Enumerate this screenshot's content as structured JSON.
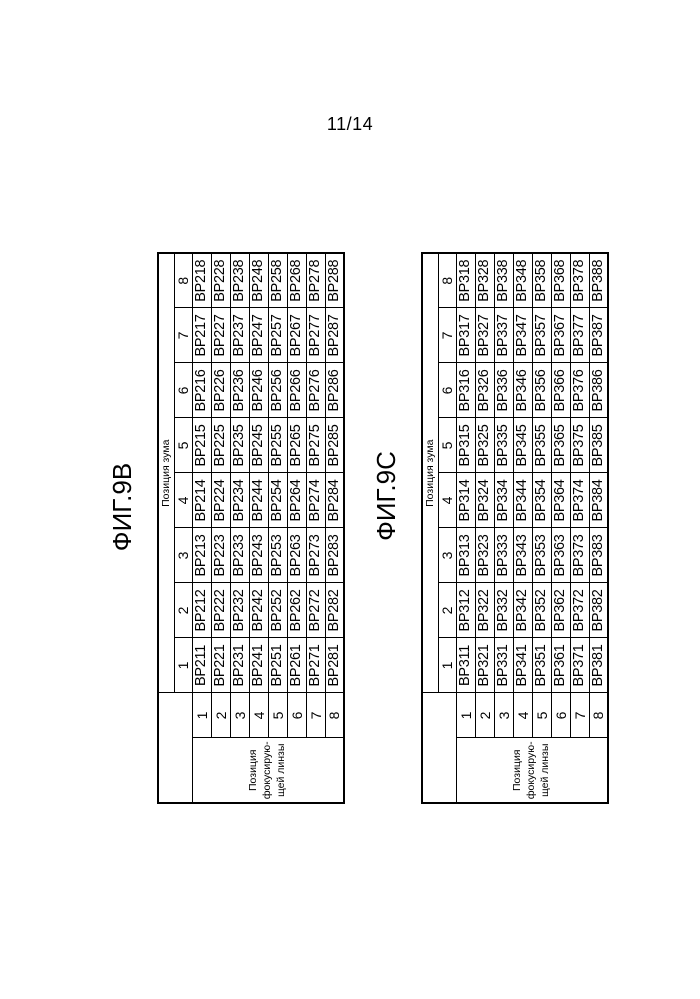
{
  "page_number": "11/14",
  "colors": {
    "ink": "#000000",
    "paper": "#ffffff"
  },
  "figures": [
    {
      "label": "ФИГ.9В",
      "zoom_header": "Позиция зума",
      "focus_header_lines": [
        "Позиция",
        "фокусирую-",
        "щей линзы"
      ],
      "zoom_positions": [
        "1",
        "2",
        "3",
        "4",
        "5",
        "6",
        "7",
        "8"
      ],
      "focus_positions": [
        "1",
        "2",
        "3",
        "4",
        "5",
        "6",
        "7",
        "8"
      ],
      "cells": [
        [
          "BP211",
          "BP212",
          "BP213",
          "BP214",
          "BP215",
          "BP216",
          "BP217",
          "BP218"
        ],
        [
          "BP221",
          "BP222",
          "BP223",
          "BP224",
          "BP225",
          "BP226",
          "BP227",
          "BP228"
        ],
        [
          "BP231",
          "BP232",
          "BP233",
          "BP234",
          "BP235",
          "BP236",
          "BP237",
          "BP238"
        ],
        [
          "BP241",
          "BP242",
          "BP243",
          "BP244",
          "BP245",
          "BP246",
          "BP247",
          "BP248"
        ],
        [
          "BP251",
          "BP252",
          "BP253",
          "BP254",
          "BP255",
          "BP256",
          "BP257",
          "BP258"
        ],
        [
          "BP261",
          "BP262",
          "BP263",
          "BP264",
          "BP265",
          "BP266",
          "BP267",
          "BP268"
        ],
        [
          "BP271",
          "BP272",
          "BP273",
          "BP274",
          "BP275",
          "BP276",
          "BP277",
          "BP278"
        ],
        [
          "BP281",
          "BP282",
          "BP283",
          "BP284",
          "BP285",
          "BP286",
          "BP287",
          "BP288"
        ]
      ]
    },
    {
      "label": "ФИГ.9С",
      "zoom_header": "Позиция зума",
      "focus_header_lines": [
        "Позиция",
        "фокусирую-",
        "щей линзы"
      ],
      "zoom_positions": [
        "1",
        "2",
        "3",
        "4",
        "5",
        "6",
        "7",
        "8"
      ],
      "focus_positions": [
        "1",
        "2",
        "3",
        "4",
        "5",
        "6",
        "7",
        "8"
      ],
      "cells": [
        [
          "BP311",
          "BP312",
          "BP313",
          "BP314",
          "BP315",
          "BP316",
          "BP317",
          "BP318"
        ],
        [
          "BP321",
          "BP322",
          "BP323",
          "BP324",
          "BP325",
          "BP326",
          "BP327",
          "BP328"
        ],
        [
          "BP331",
          "BP332",
          "BP333",
          "BP334",
          "BP335",
          "BP336",
          "BP337",
          "BP338"
        ],
        [
          "BP341",
          "BP342",
          "BP343",
          "BP344",
          "BP345",
          "BP346",
          "BP347",
          "BP348"
        ],
        [
          "BP351",
          "BP352",
          "BP353",
          "BP354",
          "BP355",
          "BP356",
          "BP357",
          "BP358"
        ],
        [
          "BP361",
          "BP362",
          "BP363",
          "BP364",
          "BP365",
          "BP366",
          "BP367",
          "BP368"
        ],
        [
          "BP371",
          "BP372",
          "BP373",
          "BP374",
          "BP375",
          "BP376",
          "BP377",
          "BP378"
        ],
        [
          "BP381",
          "BP382",
          "BP383",
          "BP384",
          "BP385",
          "BP386",
          "BP387",
          "BP388"
        ]
      ]
    }
  ]
}
